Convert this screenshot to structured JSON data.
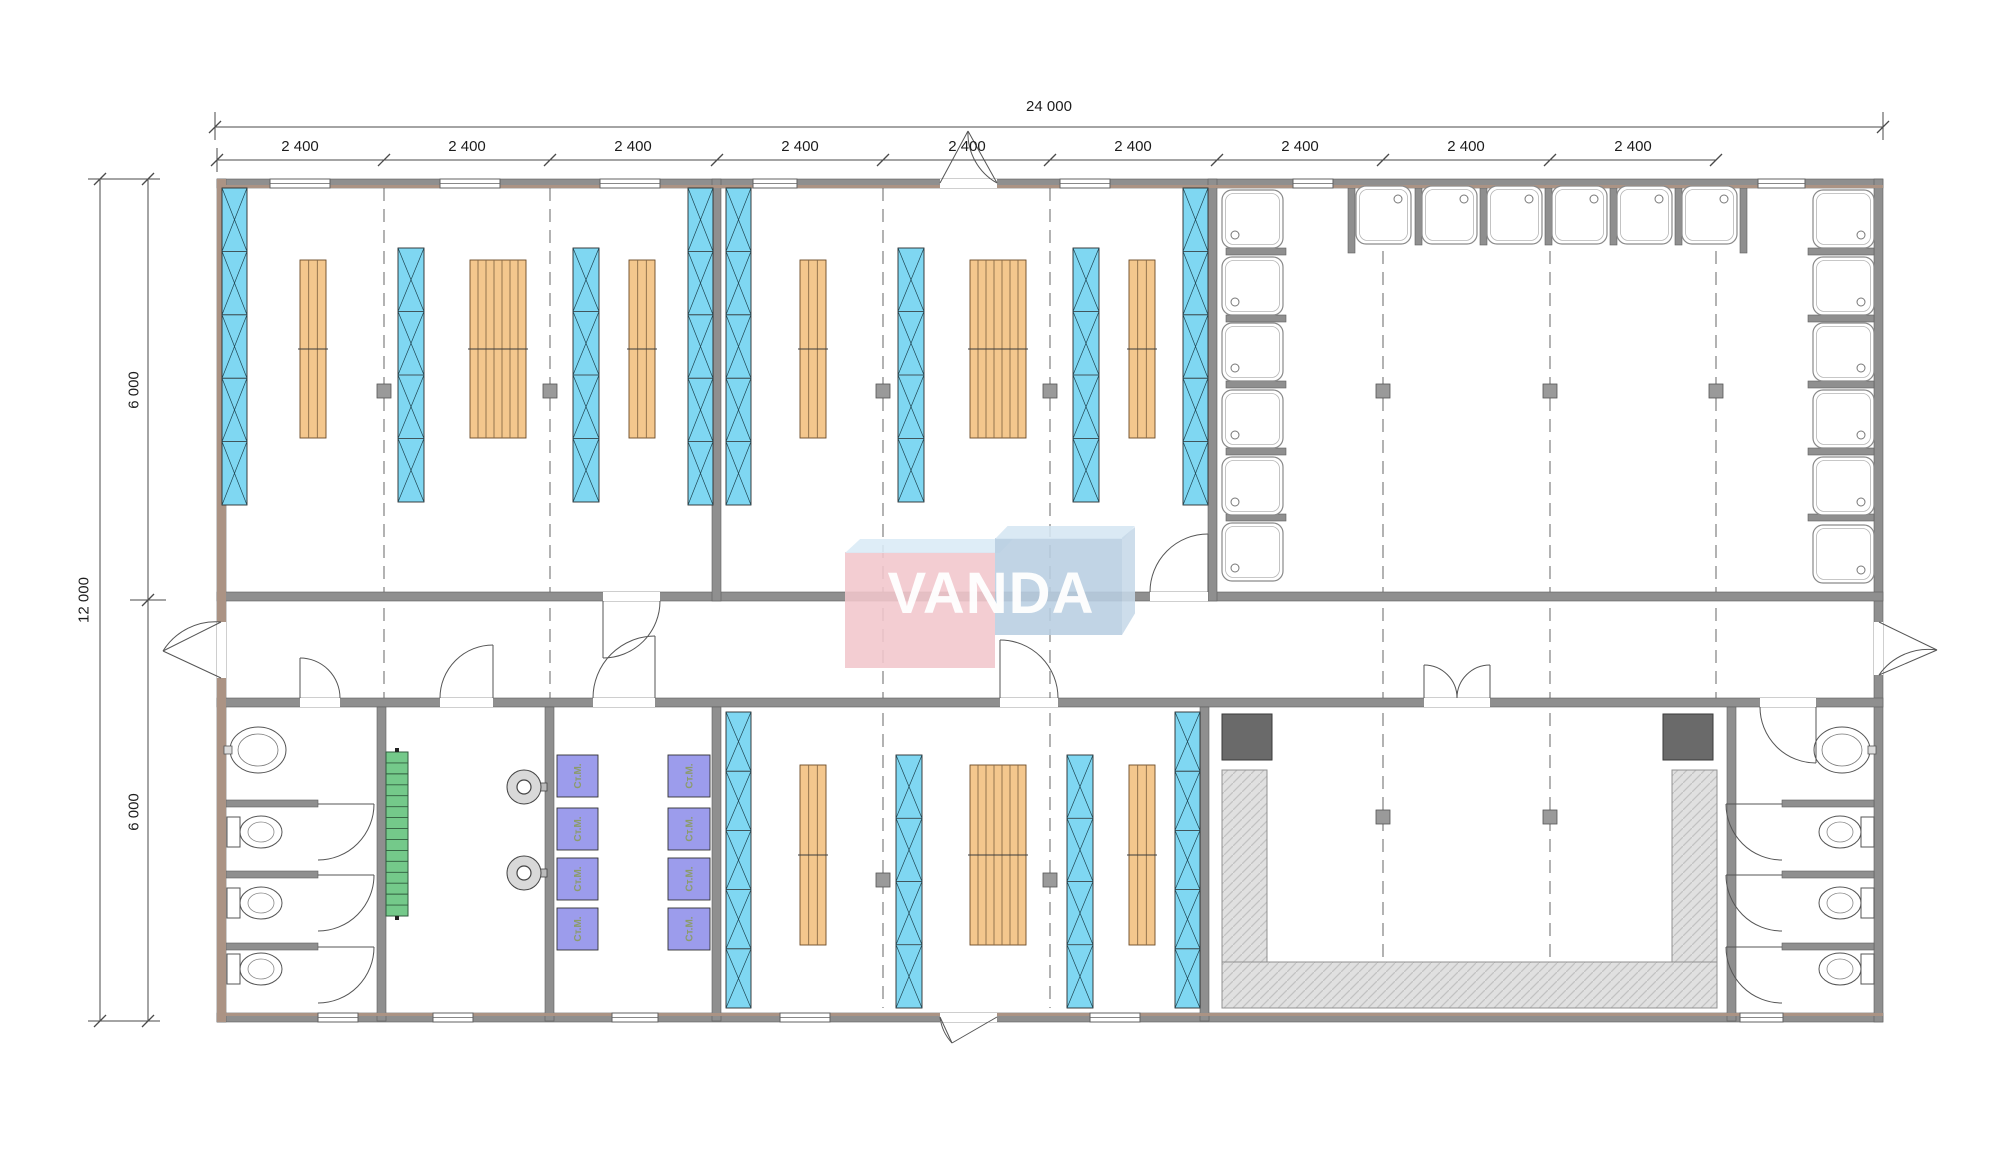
{
  "logo": {
    "text": "VANDA",
    "pink": "#F1C6CC",
    "pink_bevel": "#D9EBF6",
    "blue": "#B8CEE1",
    "blue_bevel": "#D5E6F2",
    "text_color": "#FFFFFF"
  },
  "dimensions": {
    "top_total": "24 000",
    "top_segment": "2 400",
    "top_segment_count": 9,
    "left_total": "12 000",
    "left_segment": "6 000",
    "left_segment_count": 2
  },
  "labels": {
    "washing_machine": "Ст.М."
  },
  "colors": {
    "wall": "#8F8F8F",
    "wall_edge": "#5f5f5f",
    "wall_tan": "#AB9384",
    "window_glass": "#7FD7F2",
    "bunk_blue": "#7FD7F2",
    "bench_orange": "#F4C78D",
    "stairs_green": "#74C98A",
    "machine_purple": "#9C9CEC",
    "machine_text": "#8B9B6B",
    "hatch_bg": "#E0E0E0",
    "hatch_line": "#C2C2C2",
    "stove_dark": "#6A6A6A",
    "grid": "#808080",
    "column": "#9A9A9A",
    "dim": "#4A4A4A",
    "fixture": "#555555"
  },
  "plan": {
    "grid": [
      [
        384,
        188,
        698
      ],
      [
        550,
        188,
        698
      ],
      [
        883,
        188,
        1008
      ],
      [
        1050,
        188,
        1008
      ],
      [
        1383,
        188,
        960
      ],
      [
        1550,
        188,
        960
      ],
      [
        1716,
        188,
        698
      ]
    ],
    "columns": [
      [
        377,
        384
      ],
      [
        543,
        384
      ],
      [
        876,
        384
      ],
      [
        1043,
        384
      ],
      [
        1376,
        384
      ],
      [
        1543,
        384
      ],
      [
        1709,
        384
      ],
      [
        1376,
        810
      ],
      [
        1543,
        810
      ],
      [
        876,
        873
      ],
      [
        1043,
        873
      ]
    ],
    "walls": [
      [
        217,
        179,
        1666,
        9
      ],
      [
        217,
        1013,
        1666,
        9
      ],
      [
        217,
        179,
        9,
        843
      ],
      [
        1874,
        179,
        9,
        843
      ],
      [
        217,
        592,
        1666,
        9
      ],
      [
        217,
        698,
        1666,
        9
      ],
      [
        712,
        179,
        9,
        422
      ],
      [
        1208,
        179,
        9,
        422
      ],
      [
        377,
        707,
        9,
        314
      ],
      [
        545,
        707,
        9,
        314
      ],
      [
        712,
        707,
        9,
        314
      ],
      [
        1200,
        707,
        9,
        314
      ],
      [
        1727,
        707,
        9,
        314
      ],
      [
        1226,
        248,
        60,
        7
      ],
      [
        1226,
        315,
        60,
        7
      ],
      [
        1226,
        381,
        60,
        7
      ],
      [
        1226,
        448,
        60,
        7
      ],
      [
        1226,
        514,
        60,
        7
      ],
      [
        1348,
        188,
        7,
        65
      ],
      [
        1415,
        188,
        7,
        57
      ],
      [
        1480,
        188,
        7,
        57
      ],
      [
        1545,
        188,
        7,
        57
      ],
      [
        1610,
        188,
        7,
        57
      ],
      [
        1675,
        188,
        7,
        57
      ],
      [
        1740,
        188,
        7,
        65
      ],
      [
        1808,
        248,
        66,
        7
      ],
      [
        1808,
        315,
        66,
        7
      ],
      [
        1808,
        381,
        66,
        7
      ],
      [
        1808,
        448,
        66,
        7
      ],
      [
        1808,
        514,
        66,
        7
      ],
      [
        226,
        800,
        92,
        7
      ],
      [
        226,
        871,
        92,
        7
      ],
      [
        226,
        943,
        92,
        7
      ],
      [
        1782,
        800,
        92,
        7
      ],
      [
        1782,
        871,
        92,
        7
      ],
      [
        1782,
        943,
        92,
        7
      ]
    ],
    "tan_overlays": [
      [
        217,
        179,
        9,
        843
      ],
      [
        217,
        185,
        1666,
        3
      ],
      [
        217,
        1013,
        1666,
        3
      ]
    ],
    "door_gaps": [
      [
        603,
        592,
        57,
        9
      ],
      [
        1150,
        592,
        58,
        9
      ],
      [
        300,
        698,
        40,
        9
      ],
      [
        440,
        698,
        53,
        9
      ],
      [
        593,
        698,
        62,
        9
      ],
      [
        1000,
        698,
        58,
        9
      ],
      [
        1424,
        698,
        66,
        9
      ],
      [
        1760,
        698,
        56,
        9
      ],
      [
        217,
        622,
        9,
        56
      ],
      [
        1874,
        622,
        9,
        53
      ],
      [
        940,
        179,
        57,
        9
      ],
      [
        940,
        1013,
        57,
        9
      ]
    ],
    "windows": [
      [
        270,
        179,
        60
      ],
      [
        440,
        179,
        60
      ],
      [
        600,
        179,
        60
      ],
      [
        753,
        179,
        44
      ],
      [
        1060,
        179,
        50
      ],
      [
        1293,
        179,
        40
      ],
      [
        1758,
        179,
        47
      ],
      [
        318,
        1013,
        40
      ],
      [
        433,
        1013,
        40
      ],
      [
        612,
        1013,
        46
      ],
      [
        780,
        1013,
        50
      ],
      [
        1090,
        1013,
        50
      ],
      [
        1740,
        1013,
        43
      ]
    ],
    "bunks": [
      [
        222,
        188,
        25,
        317,
        5
      ],
      [
        398,
        248,
        26,
        254,
        4
      ],
      [
        573,
        248,
        26,
        254,
        4
      ],
      [
        688,
        188,
        25,
        317,
        5
      ],
      [
        726,
        188,
        25,
        317,
        5
      ],
      [
        898,
        248,
        26,
        254,
        4
      ],
      [
        1073,
        248,
        26,
        254,
        4
      ],
      [
        1183,
        188,
        25,
        317,
        5
      ],
      [
        726,
        712,
        25,
        296,
        5
      ],
      [
        896,
        755,
        26,
        253,
        4
      ],
      [
        1067,
        755,
        26,
        253,
        4
      ],
      [
        1175,
        712,
        25,
        296,
        5
      ]
    ],
    "benches": [
      [
        300,
        260,
        26,
        178,
        3
      ],
      [
        470,
        260,
        56,
        178,
        7
      ],
      [
        629,
        260,
        26,
        178,
        3
      ],
      [
        800,
        260,
        26,
        178,
        3
      ],
      [
        970,
        260,
        56,
        178,
        7
      ],
      [
        1129,
        260,
        26,
        178,
        3
      ],
      [
        800,
        765,
        26,
        180,
        3
      ],
      [
        970,
        765,
        56,
        180,
        7
      ],
      [
        1129,
        765,
        26,
        180,
        3
      ]
    ],
    "shower_groups": [
      {
        "x": 1222,
        "w": 61,
        "h": 58,
        "ys": [
          190,
          257,
          323,
          390,
          457,
          523
        ],
        "drain": "sw"
      },
      {
        "y": 186,
        "h": 58,
        "w": 55,
        "xs": [
          1356,
          1422,
          1487,
          1552,
          1617,
          1682
        ],
        "drain": "ne"
      },
      {
        "x": 1813,
        "w": 61,
        "h": 58,
        "ys": [
          190,
          257,
          323,
          390,
          457,
          525
        ],
        "drain": "se"
      }
    ],
    "machines": {
      "cols": [
        {
          "x": 557,
          "w": 41
        },
        {
          "x": 668,
          "w": 42
        }
      ],
      "ys": [
        755,
        808,
        858,
        908
      ],
      "h": 42
    },
    "toilets": {
      "left": {
        "tank_x": 227,
        "bowl_cx": 261,
        "cys": [
          832,
          903,
          969
        ]
      },
      "right": {
        "tank_x": 1861,
        "bowl_cx": 1840,
        "cys": [
          832,
          903,
          969
        ]
      }
    },
    "sinks": [
      {
        "cx": 258,
        "cy": 750,
        "tap_x": 224
      },
      {
        "cx": 1842,
        "cy": 750,
        "tap_x": 1868
      }
    ],
    "heaters": [
      {
        "cx": 524,
        "cy": 787
      },
      {
        "cx": 524,
        "cy": 873
      }
    ],
    "stairs": {
      "x": 386,
      "y": 752,
      "w": 22,
      "h": 164,
      "treads": 15
    },
    "sauna": {
      "darks": [
        [
          1222,
          714,
          50,
          46
        ],
        [
          1663,
          714,
          50,
          46
        ]
      ],
      "arms": [
        [
          1222,
          770,
          45,
          192
        ],
        [
          1672,
          770,
          45,
          192
        ]
      ],
      "base": [
        1222,
        962,
        495,
        46
      ]
    },
    "doors": [
      {
        "leaf": [
          603,
          601,
          603,
          658
        ],
        "arc": "M603 658 A57 57 0 0 0 660 601"
      },
      {
        "leaf": [
          1208,
          592,
          1208,
          534
        ],
        "arc": "M1208 534 A58 58 0 0 0 1150 592"
      },
      {
        "leaf": [
          300,
          698,
          300,
          658
        ],
        "arc": "M300 658 A40 40 0 0 1 340 698"
      },
      {
        "leaf": [
          493,
          698,
          493,
          645
        ],
        "arc": "M493 645 A53 53 0 0 0 440 698"
      },
      {
        "leaf": [
          655,
          698,
          655,
          636
        ],
        "arc": "M655 636 A62 62 0 0 0 593 698"
      },
      {
        "leaf": [
          1000,
          698,
          1000,
          640
        ],
        "arc": "M1000 640 A58 58 0 0 1 1058 698"
      },
      {
        "leaf": [
          1424,
          698,
          1424,
          665
        ],
        "arc": "M1424 665 A33 33 0 0 1 1457 698"
      },
      {
        "leaf": [
          1490,
          698,
          1490,
          665
        ],
        "arc": "M1490 665 A33 33 0 0 0 1457 698"
      },
      {
        "leaf": [
          1816,
          707,
          1816,
          763
        ],
        "arc": "M1816 763 A56 56 0 0 1 1760 707"
      },
      {
        "leaf": [
          318,
          804,
          374,
          804
        ],
        "arc": "M374 804 A56 56 0 0 1 318 860"
      },
      {
        "leaf": [
          318,
          875,
          374,
          875
        ],
        "arc": "M374 875 A56 56 0 0 1 318 931"
      },
      {
        "leaf": [
          318,
          947,
          374,
          947
        ],
        "arc": "M374 947 A56 56 0 0 1 318 1003"
      },
      {
        "leaf": [
          1782,
          804,
          1726,
          804
        ],
        "arc": "M1726 804 A56 56 0 0 0 1782 860"
      },
      {
        "leaf": [
          1782,
          875,
          1726,
          875
        ],
        "arc": "M1726 875 A56 56 0 0 0 1782 931"
      },
      {
        "leaf": [
          1782,
          947,
          1726,
          947
        ],
        "arc": "M1726 947 A56 56 0 0 0 1782 1003"
      }
    ],
    "ext_doors": [
      {
        "lines": [
          [
            221,
            622,
            163,
            651
          ],
          [
            221,
            678,
            163,
            651
          ]
        ],
        "arc": "M221 622 A62 62 0 0 0 163 651"
      },
      {
        "lines": [
          [
            1879,
            622,
            1937,
            650
          ],
          [
            1879,
            675,
            1937,
            650
          ]
        ],
        "arc": "M1879 675 A60 60 0 0 1 1937 650"
      },
      {
        "lines": [
          [
            940,
            183,
            968,
            131
          ],
          [
            997,
            183,
            968,
            131
          ]
        ],
        "arc": "M997 183 A57 57 0 0 1 968 131"
      },
      {
        "lines": [
          [
            997,
            1017,
            952,
            1043
          ],
          [
            940,
            1017,
            952,
            1043
          ]
        ],
        "arc": "M940 1017 A46 46 0 0 0 952 1043"
      }
    ],
    "dim_lines": [
      [
        215,
        127,
        1883,
        127
      ],
      [
        217,
        160,
        1716,
        160
      ],
      [
        100,
        179,
        100,
        1021
      ],
      [
        148,
        179,
        148,
        1021
      ],
      [
        215,
        112,
        215,
        140
      ],
      [
        1883,
        112,
        1883,
        140
      ],
      [
        217,
        148,
        217,
        172
      ],
      [
        88,
        179,
        160,
        179
      ],
      [
        88,
        1021,
        160,
        1021
      ],
      [
        130,
        600,
        166,
        600
      ]
    ],
    "dim_ticks_h": [
      [
        215,
        127
      ],
      [
        1883,
        127
      ],
      [
        217,
        160
      ],
      [
        384,
        160
      ],
      [
        550,
        160
      ],
      [
        717,
        160
      ],
      [
        883,
        160
      ],
      [
        1050,
        160
      ],
      [
        1217,
        160
      ],
      [
        1383,
        160
      ],
      [
        1550,
        160
      ],
      [
        1716,
        160
      ]
    ],
    "dim_ticks_v": [
      [
        100,
        179
      ],
      [
        100,
        1021
      ],
      [
        148,
        179
      ],
      [
        148,
        600
      ],
      [
        148,
        1021
      ]
    ],
    "top_segment_label_xs": [
      300,
      467,
      633,
      800,
      967,
      1133,
      1300,
      1466,
      1633
    ],
    "left_segment_label_pos": [
      [
        134,
        390
      ],
      [
        134,
        812
      ]
    ]
  }
}
